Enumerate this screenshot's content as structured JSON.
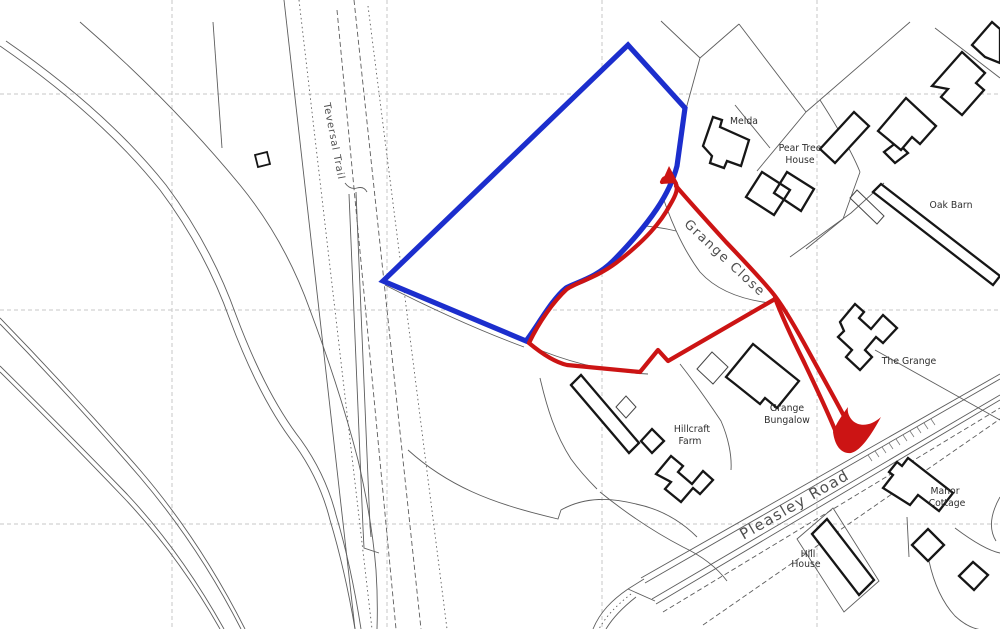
{
  "map": {
    "roads": {
      "teversal_trail": "Teversal Trail",
      "grange_close": "Grange Close",
      "pleasley_road": "Pleasley Road"
    },
    "places": {
      "melda": "Melda",
      "pear_tree_house_1": "Pear Tree",
      "pear_tree_house_2": "House",
      "oak_barn": "Oak Barn",
      "the_grange": "The Grange",
      "grange_bungalow_1": "Grange",
      "grange_bungalow_2": "Bungalow",
      "hillcraft_farm_1": "Hillcraft",
      "hillcraft_farm_2": "Farm",
      "manor_cottage_1": "Manor",
      "manor_cottage_2": "Cottage",
      "hill_house_1": "Hill",
      "hill_house_2": "House"
    },
    "colors": {
      "site_boundary": "#1c2ecd",
      "access_route": "#cc1414"
    }
  }
}
